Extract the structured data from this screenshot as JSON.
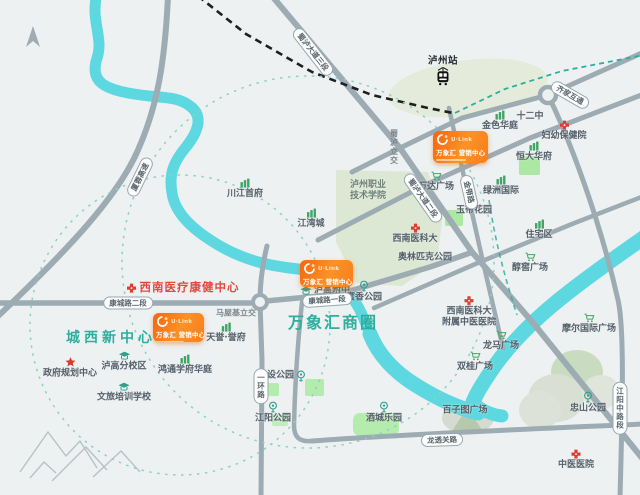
{
  "map": {
    "colors": {
      "background": "#edf1f2",
      "road": "#9dabb2",
      "river": "#5ed8e0",
      "teal_accent": "#2fae9e",
      "red_accent": "#e2483d",
      "card_orange_dark": "#f8650e",
      "card_orange_light": "#fb9227",
      "green_icon": "#3fa564",
      "park_pale": "#dde8d4",
      "park_bright": "#ace7a4",
      "railway": "#1f1f1f",
      "label_text": "#55606a"
    },
    "area_labels": [
      {
        "text": "城西新中心",
        "x": 111,
        "y": 337,
        "cls": "area-1"
      },
      {
        "text": "万象汇商圈",
        "x": 333,
        "y": 321,
        "cls": "area-2"
      }
    ],
    "highlight": {
      "text": "西南医疗康健中心",
      "x": 183,
      "y": 288
    },
    "cards": [
      {
        "brand": "U·Link",
        "name": "万象汇 营销中心",
        "x": 433,
        "y": 131,
        "w": 55,
        "h": 32
      },
      {
        "brand": "U·Link",
        "name": "万象汇 营销中心",
        "x": 300,
        "y": 260,
        "w": 53,
        "h": 27
      },
      {
        "brand": "U·Link",
        "name": "万象汇 营销中心",
        "x": 153,
        "y": 313,
        "w": 51,
        "h": 29
      }
    ],
    "road_pills": [
      {
        "text": "厦蓉高速",
        "x": 140,
        "y": 177,
        "rot": -64
      },
      {
        "text": "蜀泸大道三段",
        "x": 313,
        "y": 52,
        "rot": 52
      },
      {
        "text": "蜀泸大道二段",
        "x": 423,
        "y": 198,
        "rot": 55
      },
      {
        "text": "金带路",
        "x": 469,
        "y": 192,
        "rot": 77
      },
      {
        "text": "齐家互通",
        "x": 570,
        "y": 95,
        "rot": 30
      },
      {
        "text": "康城路二段",
        "x": 128,
        "y": 303,
        "rot": 0
      },
      {
        "text": "康城路一段",
        "x": 327,
        "y": 300,
        "rot": -4
      },
      {
        "text": "一环路",
        "x": 261,
        "y": 386,
        "vertical": true
      },
      {
        "text": "江阳中路段",
        "x": 620,
        "y": 408,
        "vertical": true
      },
      {
        "text": "龙透关路",
        "x": 442,
        "y": 440,
        "rot": -2
      }
    ],
    "road_names": [
      {
        "text": "蜀泸立交",
        "x": 394,
        "y": 147,
        "vertical": true
      },
      {
        "text": "马屋基立交",
        "x": 236,
        "y": 313
      }
    ],
    "pois": [
      {
        "text": "泸州站",
        "x": 443,
        "y": 71,
        "icon": "train",
        "iconside": "bottom",
        "cls": "dark"
      },
      {
        "text": "金色华庭",
        "x": 500,
        "y": 121,
        "icon": "building"
      },
      {
        "text": "十二中",
        "x": 530,
        "y": 117,
        "icon": "none"
      },
      {
        "text": "妇幼保健院",
        "x": 564,
        "y": 131,
        "icon": "cross"
      },
      {
        "text": "恒大华府",
        "x": 534,
        "y": 152,
        "icon": "building"
      },
      {
        "text": "绿洲国际",
        "x": 501,
        "y": 186,
        "icon": "building"
      },
      {
        "text": "万达广场",
        "x": 436,
        "y": 182,
        "icon": "cart"
      },
      {
        "text": "玉带花园",
        "x": 474,
        "y": 211,
        "icon": "none"
      },
      {
        "text": "住宅区",
        "x": 539,
        "y": 230,
        "icon": "building"
      },
      {
        "text": "醇窖广场",
        "x": 530,
        "y": 263,
        "icon": "cart"
      },
      {
        "lines": [
          "泸州职业",
          "技术学院"
        ],
        "x": 368,
        "y": 191,
        "icon": "none",
        "cls": "campus"
      },
      {
        "text": "西南医科大",
        "x": 415,
        "y": 234,
        "icon": "cross"
      },
      {
        "text": "奥林匹克公园",
        "x": 425,
        "y": 258,
        "icon": "none"
      },
      {
        "text": "蜜香公园",
        "x": 364,
        "y": 292,
        "icon": "park"
      },
      {
        "text": "泸高附中",
        "x": 325,
        "y": 291,
        "icon": "school",
        "iconside": "left"
      },
      {
        "text": "川江首府",
        "x": 245,
        "y": 189,
        "icon": "building"
      },
      {
        "text": "江湾城",
        "x": 311,
        "y": 219,
        "icon": "building"
      },
      {
        "lines": [
          "西南医科大",
          "附属中医医院"
        ],
        "x": 469,
        "y": 312,
        "icon": "cross"
      },
      {
        "text": "摩尔国际广场",
        "x": 589,
        "y": 324,
        "icon": "cart"
      },
      {
        "text": "龙马广场",
        "x": 501,
        "y": 341,
        "icon": "cart"
      },
      {
        "text": "双桂广场",
        "x": 475,
        "y": 362,
        "icon": "cart"
      },
      {
        "text": "百子图广场",
        "x": 465,
        "y": 411,
        "icon": "none"
      },
      {
        "text": "忠山公园",
        "x": 588,
        "y": 403,
        "icon": "park"
      },
      {
        "text": "中医医院",
        "x": 576,
        "y": 460,
        "icon": "cross"
      },
      {
        "text": "建设公园",
        "x": 282,
        "y": 376,
        "icon": "park",
        "iconside": "right"
      },
      {
        "text": "江阳公园",
        "x": 273,
        "y": 413,
        "icon": "park"
      },
      {
        "text": "酒城乐园",
        "x": 384,
        "y": 413,
        "icon": "park"
      },
      {
        "text": "天誉·誉府",
        "x": 226,
        "y": 333,
        "icon": "building"
      },
      {
        "text": "鸿通学府华庭",
        "x": 185,
        "y": 365,
        "icon": "building"
      },
      {
        "text": "泸高分校区",
        "x": 124,
        "y": 362,
        "icon": "school"
      },
      {
        "text": "文旅培训学校",
        "x": 124,
        "y": 393,
        "icon": "school"
      },
      {
        "text": "政府规划中心",
        "x": 70,
        "y": 368,
        "icon": "star"
      }
    ]
  }
}
